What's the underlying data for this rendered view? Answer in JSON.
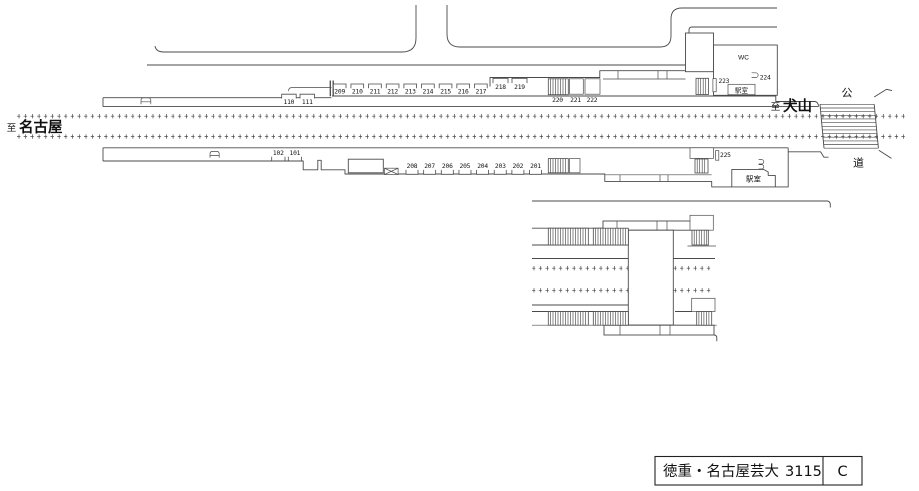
{
  "labels": {
    "to_left": {
      "prefix": "至",
      "name": "名古屋"
    },
    "to_right": {
      "prefix": "至",
      "name": "犬山"
    },
    "road_vertical": [
      "公",
      "道"
    ],
    "wc": "WC",
    "office_top": "駅室",
    "office_bottom": "駅室"
  },
  "ad_positions": {
    "p1_left": [
      "110",
      "111"
    ],
    "p1_row": [
      "209",
      "210",
      "211",
      "212",
      "213",
      "214",
      "215",
      "216",
      "217"
    ],
    "p1_upper": [
      "218",
      "219"
    ],
    "p1_mid": [
      "220",
      "221",
      "222"
    ],
    "p1_right": [
      "223",
      "224"
    ],
    "p2_left": [
      "102",
      "101"
    ],
    "p2_row": [
      "208",
      "207",
      "206",
      "205",
      "204",
      "203",
      "202",
      "201"
    ],
    "p2_right": [
      "225"
    ]
  },
  "title_box": {
    "station_name": "徳重・名古屋芸大",
    "station_code": "3115",
    "grade": "C"
  },
  "colors": {
    "line": "#4a4a4a",
    "text": "#111111",
    "background": "#ffffff"
  }
}
